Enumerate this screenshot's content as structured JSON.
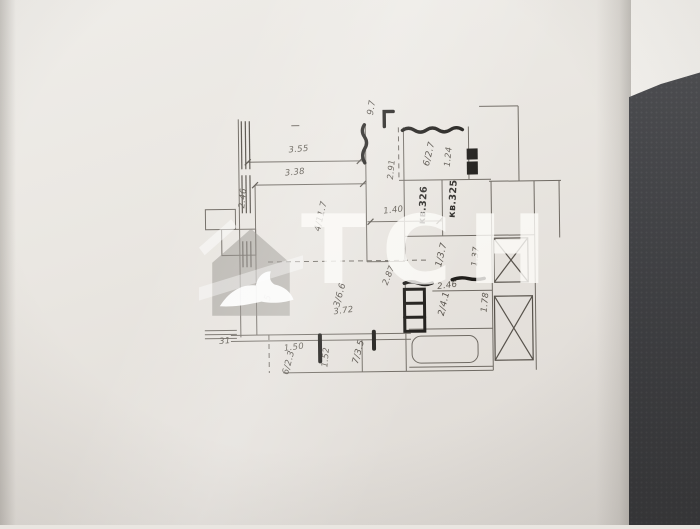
{
  "scene": {
    "description": "Photograph of an architectural floor plan printed on white paper lying on a dark textured desk, with a translucent agency watermark",
    "paper_color": "#e9e6e1",
    "desk_color": "#45464a",
    "line_color": "#6f6a63",
    "bold_wall_color": "#1f1d1a"
  },
  "watermark": {
    "text": "ТСН",
    "icon": "house-with-bird-logo"
  },
  "floorplan": {
    "apartments": [
      "кв.325",
      "кв.326"
    ],
    "labels": [
      {
        "text": "3.55",
        "kind": "dimension"
      },
      {
        "text": "3.38",
        "kind": "dimension"
      },
      {
        "text": "2.46",
        "kind": "dimension"
      },
      {
        "text": "4/11.7",
        "kind": "room"
      },
      {
        "text": "9.7",
        "kind": "room"
      },
      {
        "text": "2.91",
        "kind": "dimension"
      },
      {
        "text": "6/2.7",
        "kind": "room"
      },
      {
        "text": "1.24",
        "kind": "dimension"
      },
      {
        "text": "кв.326",
        "kind": "apartment"
      },
      {
        "text": "кв.325",
        "kind": "apartment"
      },
      {
        "text": "1.40",
        "kind": "dimension"
      },
      {
        "text": "1/3.7",
        "kind": "room"
      },
      {
        "text": "1.37",
        "kind": "dimension"
      },
      {
        "text": "2.87",
        "kind": "dimension"
      },
      {
        "text": "2.46",
        "kind": "dimension"
      },
      {
        "text": "2/4.1",
        "kind": "room"
      },
      {
        "text": "1.78",
        "kind": "dimension"
      },
      {
        "text": "3/6.6",
        "kind": "room"
      },
      {
        "text": "3.72",
        "kind": "dimension"
      },
      {
        "text": "5",
        "kind": "room"
      },
      {
        "text": "31",
        "kind": "dimension"
      },
      {
        "text": "1.50",
        "kind": "dimension"
      },
      {
        "text": "6/2.3",
        "kind": "room"
      },
      {
        "text": "1.52",
        "kind": "dimension"
      },
      {
        "text": "7/3.5",
        "kind": "room"
      }
    ]
  }
}
